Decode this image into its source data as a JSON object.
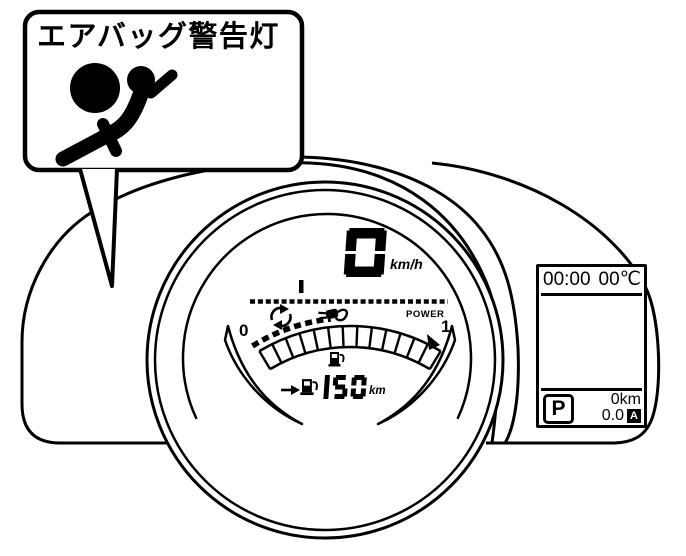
{
  "colors": {
    "ink": "#000000",
    "bg": "#ffffff"
  },
  "callout": {
    "label": "エアバッグ警告灯",
    "icon": "airbag-warning-icon"
  },
  "cluster": {
    "speed": {
      "value": "0",
      "unit": "km/h"
    },
    "power_meter": {
      "label": "POWER",
      "min_label": "0",
      "max_label": "1",
      "segments": 13,
      "charge_dashes_shown": true,
      "zero_tick_shown": true
    },
    "range": {
      "value": "150",
      "unit": "km"
    },
    "icons": {
      "regen": "regen-arrows-icon",
      "charging_plug": "charging-plug-icon",
      "fuel_gauge": "fuel-pump-icon",
      "range_row": [
        "arrow-right-icon",
        "fuel-pump-icon"
      ]
    }
  },
  "side_display": {
    "clock": "00:00",
    "temperature": "00℃",
    "gear_indicator": "P",
    "distance": "0km",
    "trip_value": "0.0",
    "trip_mode": "A"
  }
}
